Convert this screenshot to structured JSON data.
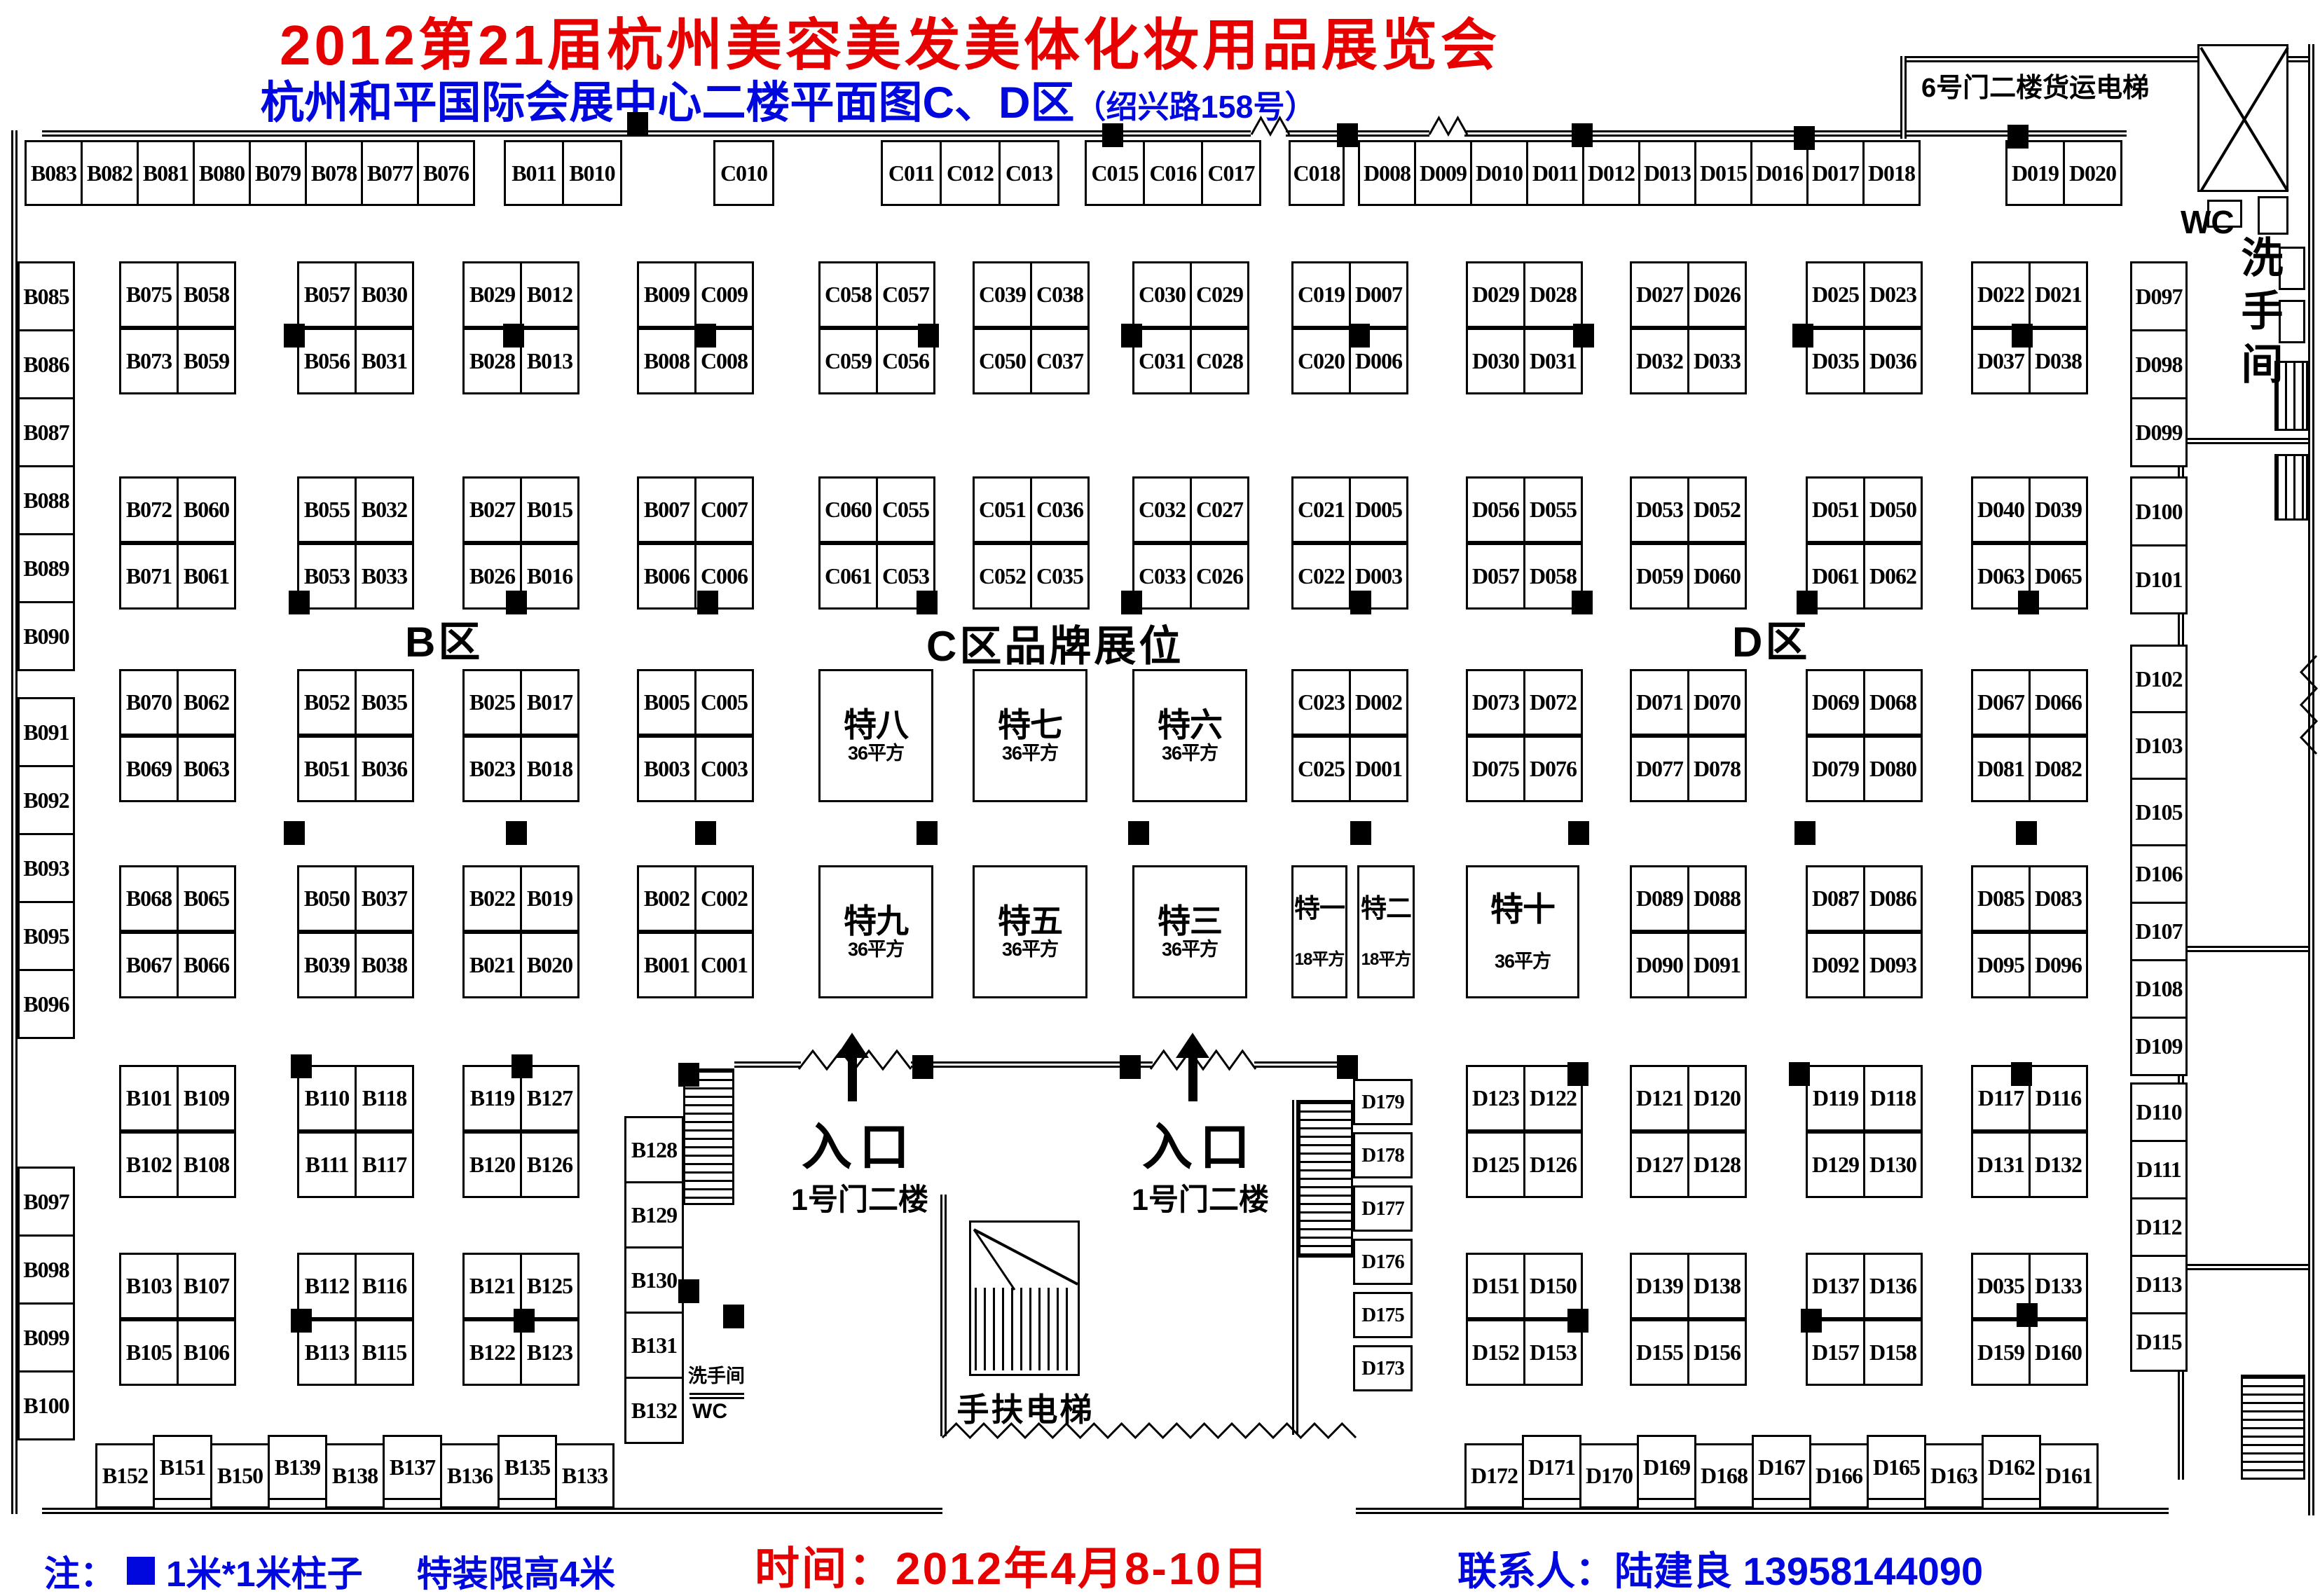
{
  "header": {
    "title": "2012第21届杭州美容美发美体化妆用品展览会",
    "subtitle": "杭州和平国际会展中心二楼平面图C、D区",
    "subtitle_suffix": "（绍兴路158号）",
    "freight_elevator_label": "6号门二楼货运电梯"
  },
  "zones": {
    "b": "B区",
    "c": "C区品牌展位",
    "d": "D区"
  },
  "entrances": {
    "label": "入口",
    "gate": "1号门二楼"
  },
  "facilities": {
    "escalator": "手扶电梯",
    "restroom": "洗手间",
    "wc": "WC"
  },
  "footer": {
    "note_prefix": "注：",
    "note_pillar": "1米*1米柱子",
    "note_height": "特装限高4米",
    "time": "时间：2012年4月8-10日",
    "contact": "联系人：陆建良 13958144090"
  },
  "colors": {
    "title_red": "#e60000",
    "text_blue": "#0008dd",
    "plan_black": "#000000"
  },
  "booths": {
    "top_row_segments": [
      [
        "B083",
        "B082",
        "B081",
        "B080",
        "B079",
        "B078",
        "B077",
        "B076"
      ],
      [
        "B011",
        "B010"
      ],
      [
        "C010"
      ],
      [
        "C011",
        "C012",
        "C013"
      ],
      [
        "C015",
        "C016",
        "C017"
      ],
      [
        "C018"
      ],
      [
        "D008",
        "D009",
        "D010",
        "D011",
        "D012",
        "D013",
        "D015",
        "D016",
        "D017",
        "D018"
      ],
      [
        "D019",
        "D020"
      ]
    ],
    "left_column_segments": [
      [
        "B085",
        "B086",
        "B087",
        "B088",
        "B089",
        "B090"
      ],
      [
        "B091",
        "B092",
        "B093",
        "B095",
        "B096"
      ],
      [
        "B097",
        "B098",
        "B099",
        "B100"
      ]
    ],
    "right_column_segments": [
      [
        "D097",
        "D098",
        "D099"
      ],
      [
        "D100",
        "D101"
      ],
      [
        "D102",
        "D103",
        "D105"
      ],
      [
        "D106",
        "D107",
        "D108",
        "D109"
      ],
      [
        "D110",
        "D111",
        "D112",
        "D113",
        "D115"
      ]
    ],
    "island_blocks": [
      {
        "band": 0,
        "col": 0,
        "cells": [
          [
            "B075",
            "B058"
          ],
          [
            "B073",
            "B059"
          ]
        ]
      },
      {
        "band": 0,
        "col": 1,
        "cells": [
          [
            "B057",
            "B030"
          ],
          [
            "B056",
            "B031"
          ]
        ]
      },
      {
        "band": 0,
        "col": 2,
        "cells": [
          [
            "B029",
            "B012"
          ],
          [
            "B028",
            "B013"
          ]
        ]
      },
      {
        "band": 0,
        "col": 3,
        "cells": [
          [
            "B009",
            "C009"
          ],
          [
            "B008",
            "C008"
          ]
        ]
      },
      {
        "band": 0,
        "col": 4,
        "cells": [
          [
            "C058",
            "C057"
          ],
          [
            "C059",
            "C056"
          ]
        ]
      },
      {
        "band": 0,
        "col": 5,
        "cells": [
          [
            "C039",
            "C038"
          ],
          [
            "C050",
            "C037"
          ]
        ]
      },
      {
        "band": 0,
        "col": 6,
        "cells": [
          [
            "C030",
            "C029"
          ],
          [
            "C031",
            "C028"
          ]
        ]
      },
      {
        "band": 0,
        "col": 7,
        "cells": [
          [
            "C019",
            "D007"
          ],
          [
            "C020",
            "D006"
          ]
        ]
      },
      {
        "band": 0,
        "col": 8,
        "cells": [
          [
            "D029",
            "D028"
          ],
          [
            "D030",
            "D031"
          ]
        ]
      },
      {
        "band": 0,
        "col": 9,
        "cells": [
          [
            "D027",
            "D026"
          ],
          [
            "D032",
            "D033"
          ]
        ]
      },
      {
        "band": 0,
        "col": 10,
        "cells": [
          [
            "D025",
            "D023"
          ],
          [
            "D035",
            "D036"
          ]
        ]
      },
      {
        "band": 0,
        "col": 11,
        "cells": [
          [
            "D022",
            "D021"
          ],
          [
            "D037",
            "D038"
          ]
        ]
      },
      {
        "band": 1,
        "col": 0,
        "cells": [
          [
            "B072",
            "B060"
          ],
          [
            "B071",
            "B061"
          ]
        ]
      },
      {
        "band": 1,
        "col": 1,
        "cells": [
          [
            "B055",
            "B032"
          ],
          [
            "B053",
            "B033"
          ]
        ]
      },
      {
        "band": 1,
        "col": 2,
        "cells": [
          [
            "B027",
            "B015"
          ],
          [
            "B026",
            "B016"
          ]
        ]
      },
      {
        "band": 1,
        "col": 3,
        "cells": [
          [
            "B007",
            "C007"
          ],
          [
            "B006",
            "C006"
          ]
        ]
      },
      {
        "band": 1,
        "col": 4,
        "cells": [
          [
            "C060",
            "C055"
          ],
          [
            "C061",
            "C053"
          ]
        ]
      },
      {
        "band": 1,
        "col": 5,
        "cells": [
          [
            "C051",
            "C036"
          ],
          [
            "C052",
            "C035"
          ]
        ]
      },
      {
        "band": 1,
        "col": 6,
        "cells": [
          [
            "C032",
            "C027"
          ],
          [
            "C033",
            "C026"
          ]
        ]
      },
      {
        "band": 1,
        "col": 7,
        "cells": [
          [
            "C021",
            "D005"
          ],
          [
            "C022",
            "D003"
          ]
        ]
      },
      {
        "band": 1,
        "col": 8,
        "cells": [
          [
            "D056",
            "D055"
          ],
          [
            "D057",
            "D058"
          ]
        ]
      },
      {
        "band": 1,
        "col": 9,
        "cells": [
          [
            "D053",
            "D052"
          ],
          [
            "D059",
            "D060"
          ]
        ]
      },
      {
        "band": 1,
        "col": 10,
        "cells": [
          [
            "D051",
            "D050"
          ],
          [
            "D061",
            "D062"
          ]
        ]
      },
      {
        "band": 1,
        "col": 11,
        "cells": [
          [
            "D040",
            "D039"
          ],
          [
            "D063",
            "D065"
          ]
        ]
      },
      {
        "band": 2,
        "col": 0,
        "cells": [
          [
            "B070",
            "B062"
          ],
          [
            "B069",
            "B063"
          ]
        ]
      },
      {
        "band": 2,
        "col": 1,
        "cells": [
          [
            "B052",
            "B035"
          ],
          [
            "B051",
            "B036"
          ]
        ]
      },
      {
        "band": 2,
        "col": 2,
        "cells": [
          [
            "B025",
            "B017"
          ],
          [
            "B023",
            "B018"
          ]
        ]
      },
      {
        "band": 2,
        "col": 3,
        "cells": [
          [
            "B005",
            "C005"
          ],
          [
            "B003",
            "C003"
          ]
        ]
      },
      {
        "band": 2,
        "col": 7,
        "cells": [
          [
            "C023",
            "D002"
          ],
          [
            "C025",
            "D001"
          ]
        ]
      },
      {
        "band": 2,
        "col": 8,
        "cells": [
          [
            "D073",
            "D072"
          ],
          [
            "D075",
            "D076"
          ]
        ]
      },
      {
        "band": 2,
        "col": 9,
        "cells": [
          [
            "D071",
            "D070"
          ],
          [
            "D077",
            "D078"
          ]
        ]
      },
      {
        "band": 2,
        "col": 10,
        "cells": [
          [
            "D069",
            "D068"
          ],
          [
            "D079",
            "D080"
          ]
        ]
      },
      {
        "band": 2,
        "col": 11,
        "cells": [
          [
            "D067",
            "D066"
          ],
          [
            "D081",
            "D082"
          ]
        ]
      },
      {
        "band": 3,
        "col": 0,
        "cells": [
          [
            "B068",
            "B065"
          ],
          [
            "B067",
            "B066"
          ]
        ]
      },
      {
        "band": 3,
        "col": 1,
        "cells": [
          [
            "B050",
            "B037"
          ],
          [
            "B039",
            "B038"
          ]
        ]
      },
      {
        "band": 3,
        "col": 2,
        "cells": [
          [
            "B022",
            "B019"
          ],
          [
            "B021",
            "B020"
          ]
        ]
      },
      {
        "band": 3,
        "col": 3,
        "cells": [
          [
            "B002",
            "C002"
          ],
          [
            "B001",
            "C001"
          ]
        ]
      },
      {
        "band": 3,
        "col": 9,
        "cells": [
          [
            "D089",
            "D088"
          ],
          [
            "D090",
            "D091"
          ]
        ]
      },
      {
        "band": 3,
        "col": 10,
        "cells": [
          [
            "D087",
            "D086"
          ],
          [
            "D092",
            "D093"
          ]
        ]
      },
      {
        "band": 3,
        "col": 11,
        "cells": [
          [
            "D085",
            "D083"
          ],
          [
            "D095",
            "D096"
          ]
        ]
      },
      {
        "band": 4,
        "col": 0,
        "cells": [
          [
            "B101",
            "B109"
          ],
          [
            "B102",
            "B108"
          ]
        ]
      },
      {
        "band": 4,
        "col": 1,
        "cells": [
          [
            "B110",
            "B118"
          ],
          [
            "B111",
            "B117"
          ]
        ]
      },
      {
        "band": 4,
        "col": 2,
        "cells": [
          [
            "B119",
            "B127"
          ],
          [
            "B120",
            "B126"
          ]
        ]
      },
      {
        "band": 4,
        "col": 8,
        "cells": [
          [
            "D123",
            "D122"
          ],
          [
            "D125",
            "D126"
          ]
        ]
      },
      {
        "band": 4,
        "col": 9,
        "cells": [
          [
            "D121",
            "D120"
          ],
          [
            "D127",
            "D128"
          ]
        ]
      },
      {
        "band": 4,
        "col": 10,
        "cells": [
          [
            "D119",
            "D118"
          ],
          [
            "D129",
            "D130"
          ]
        ]
      },
      {
        "band": 4,
        "col": 11,
        "cells": [
          [
            "D117",
            "D116"
          ],
          [
            "D131",
            "D132"
          ]
        ]
      },
      {
        "band": 5,
        "col": 0,
        "cells": [
          [
            "B103",
            "B107"
          ],
          [
            "B105",
            "B106"
          ]
        ]
      },
      {
        "band": 5,
        "col": 1,
        "cells": [
          [
            "B112",
            "B116"
          ],
          [
            "B113",
            "B115"
          ]
        ]
      },
      {
        "band": 5,
        "col": 2,
        "cells": [
          [
            "B121",
            "B125"
          ],
          [
            "B122",
            "B123"
          ]
        ]
      },
      {
        "band": 5,
        "col": 8,
        "cells": [
          [
            "D151",
            "D150"
          ],
          [
            "D152",
            "D153"
          ]
        ]
      },
      {
        "band": 5,
        "col": 9,
        "cells": [
          [
            "D139",
            "D138"
          ],
          [
            "D155",
            "D156"
          ]
        ]
      },
      {
        "band": 5,
        "col": 10,
        "cells": [
          [
            "D137",
            "D136"
          ],
          [
            "D157",
            "D158"
          ]
        ]
      },
      {
        "band": 5,
        "col": 11,
        "cells": [
          [
            "D035",
            "D133"
          ],
          [
            "D159",
            "D160"
          ]
        ]
      }
    ],
    "b_column": [
      "B128",
      "B129",
      "B130",
      "B131",
      "B132"
    ],
    "d_column": [
      "D179",
      "D178",
      "D177",
      "D176",
      "D175",
      "D173"
    ],
    "bottom_left_row": [
      "B152",
      "B151",
      "B150",
      "B139",
      "B138",
      "B137",
      "B136",
      "B135",
      "B133"
    ],
    "bottom_right_row": [
      "D172",
      "D171",
      "D170",
      "D169",
      "D168",
      "D167",
      "D166",
      "D165",
      "D163",
      "D162",
      "D161"
    ]
  },
  "special_booths": [
    {
      "slot": "te8",
      "name": "特八",
      "area": "36平方"
    },
    {
      "slot": "te7",
      "name": "特七",
      "area": "36平方"
    },
    {
      "slot": "te6",
      "name": "特六",
      "area": "36平方"
    },
    {
      "slot": "te9",
      "name": "特九",
      "area": "36平方"
    },
    {
      "slot": "te5",
      "name": "特五",
      "area": "36平方"
    },
    {
      "slot": "te3",
      "name": "特三",
      "area": "36平方"
    },
    {
      "slot": "te1",
      "name": "特一",
      "area": "18平方"
    },
    {
      "slot": "te2",
      "name": "特二",
      "area": "18平方"
    },
    {
      "slot": "te10",
      "name": "特十",
      "area": "36平方"
    }
  ]
}
